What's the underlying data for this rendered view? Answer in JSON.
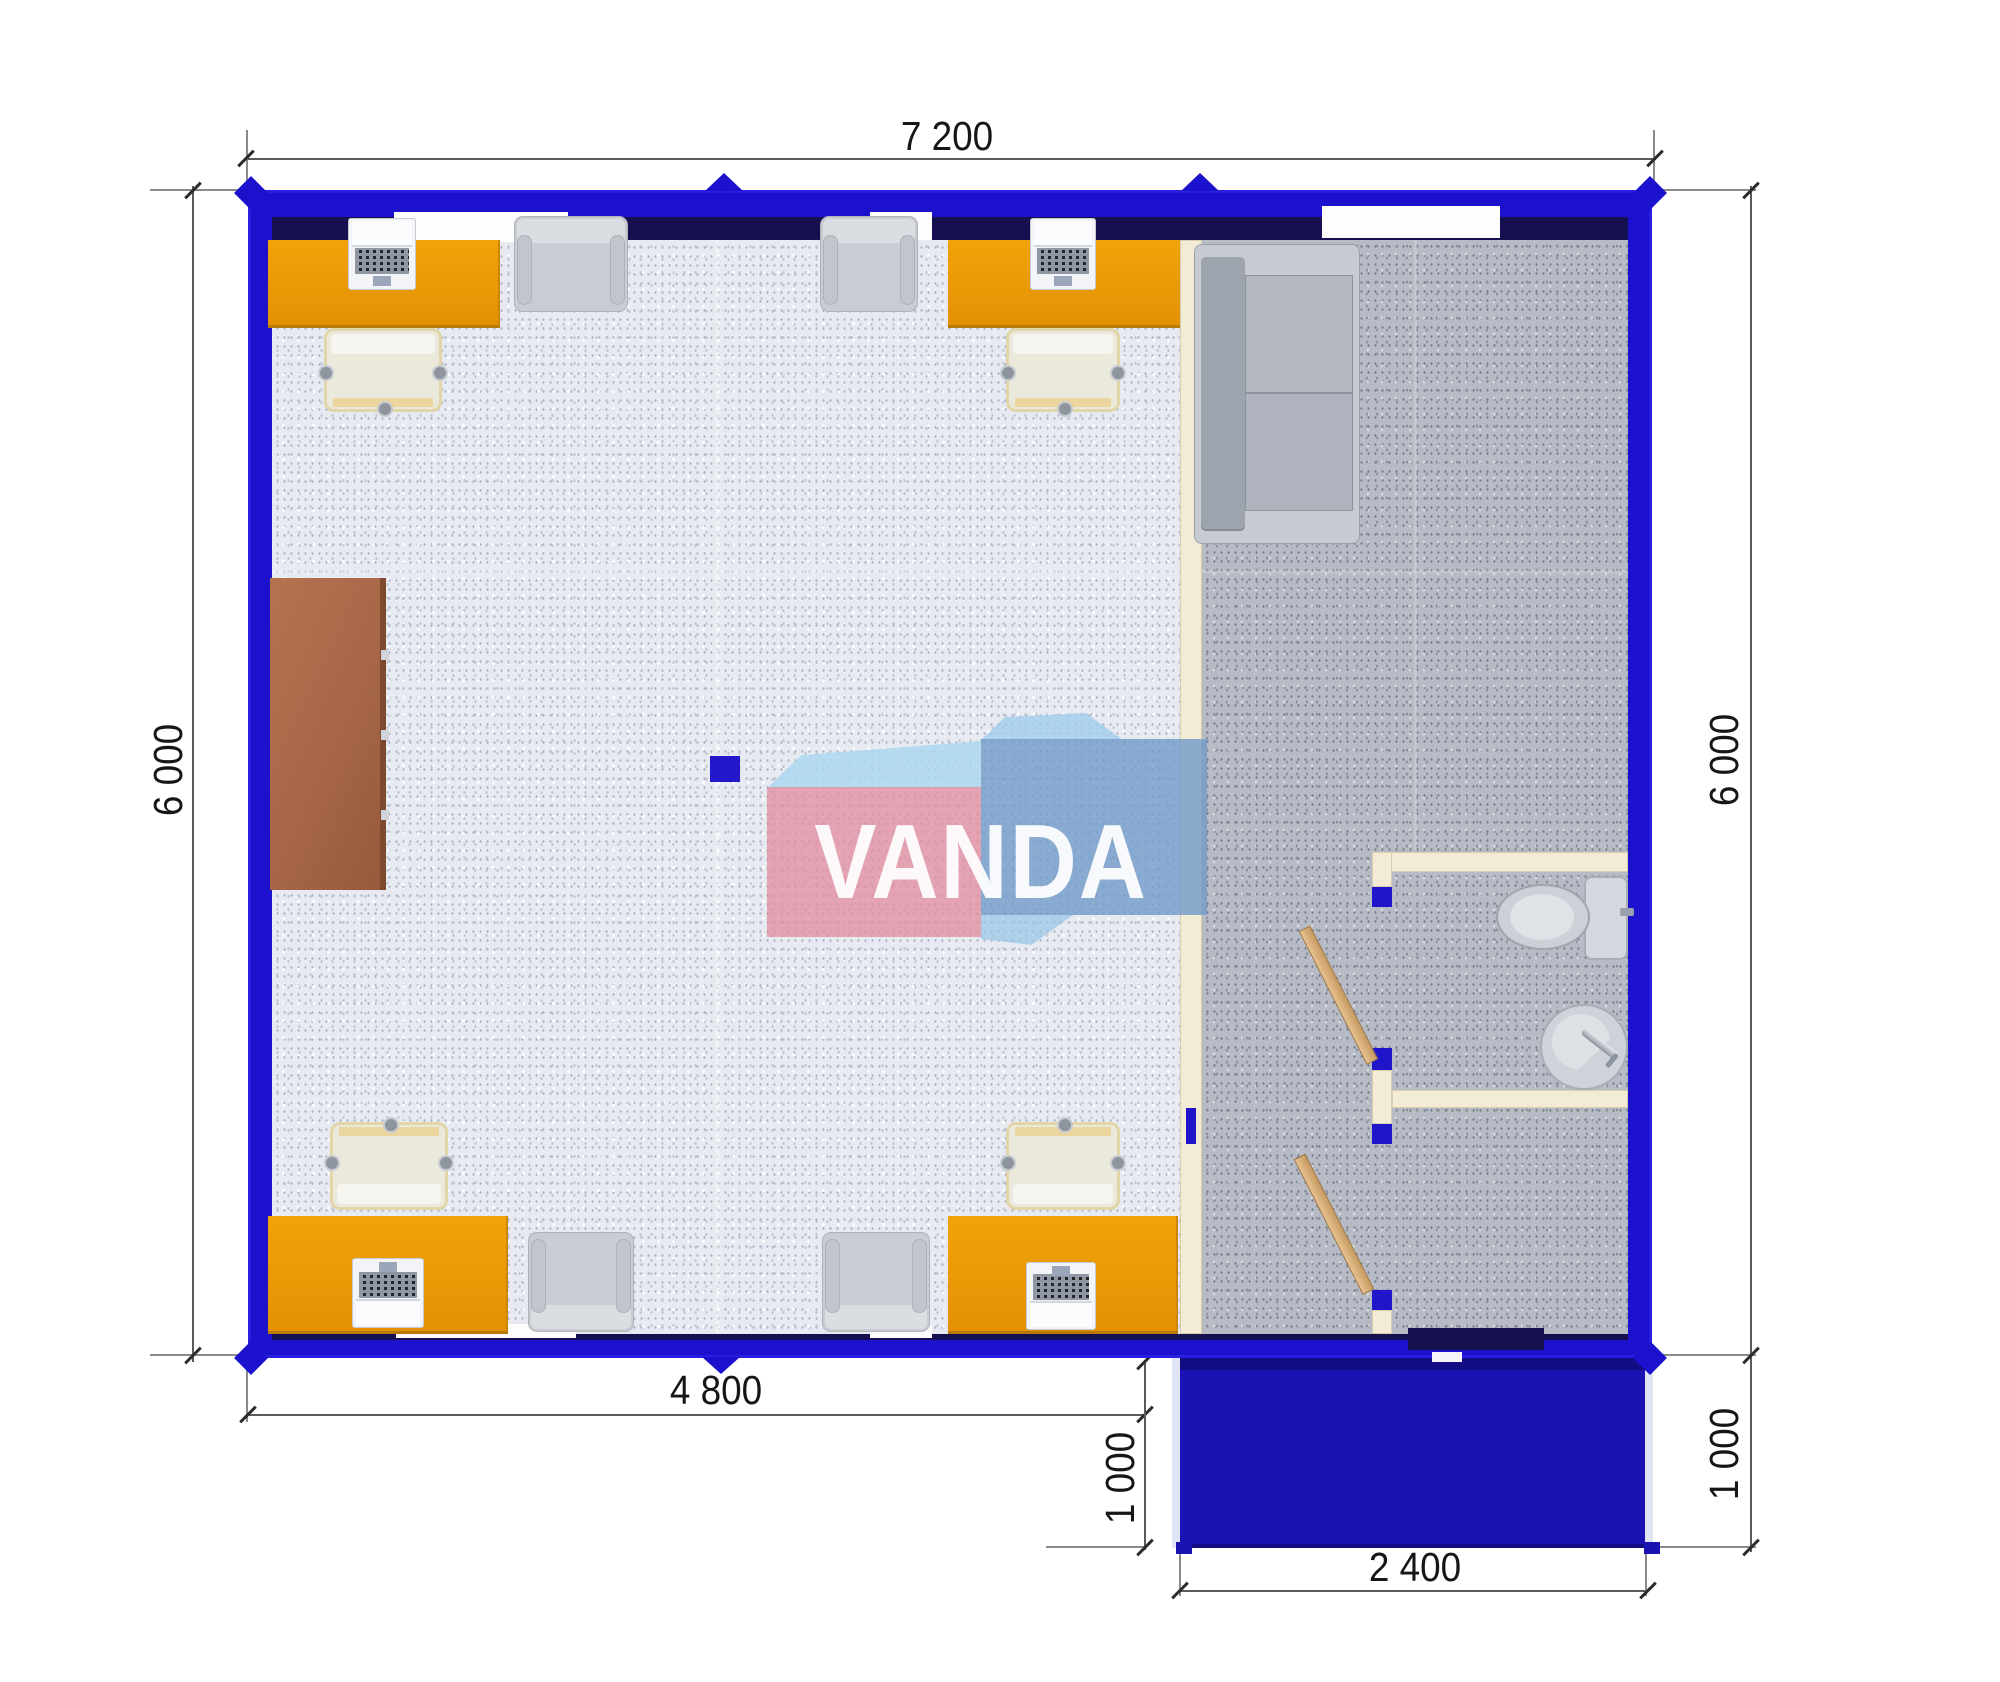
{
  "page": {
    "type": "modular-office-container-floor-plan-top-view",
    "background": "#ffffff"
  },
  "watermark": {
    "text": "VANDA"
  },
  "dimensions": {
    "top": "7 200",
    "left": "6 000",
    "right": "6 000",
    "bottom_office": "4 800",
    "porch_left": "1 000",
    "porch_right": "1 000",
    "porch_width": "2 400"
  },
  "colors": {
    "wall_blue": "#1c12cd",
    "wall_inner_navy": "#171050",
    "porch_blue": "#1a12b2",
    "desk_orange": "#ec9b06",
    "cabinet_brown": "#a96a4a",
    "partition_cream": "#f2ecd6",
    "door_wood": "#d9b17e",
    "floor_office": "#e8eaf1",
    "floor_hallway": "#b6bbc6",
    "furniture_gray": "#c7cbd1",
    "logo_pink": "#e38ea0",
    "logo_blue": "#7099c8",
    "logo_light_blue": "#addaf0",
    "dimension_text": "#161616"
  },
  "rooms": {
    "office": "open-plan office with four workstations",
    "hallway": "entrance hall with sofa",
    "wc": "toilet room with toilet and wash basin",
    "store": "small back room",
    "porch": "entrance canopy"
  },
  "furniture": {
    "office": [
      "orange-desk x4",
      "laptop x4",
      "office-chair x4",
      "visitor-armchair x4",
      "brown-cabinet",
      "support-column"
    ],
    "hallway": [
      "gray-sofa"
    ],
    "wc": [
      "toilet",
      "wash-basin"
    ],
    "doors": [
      "wooden-door x2",
      "entrance-door"
    ]
  }
}
